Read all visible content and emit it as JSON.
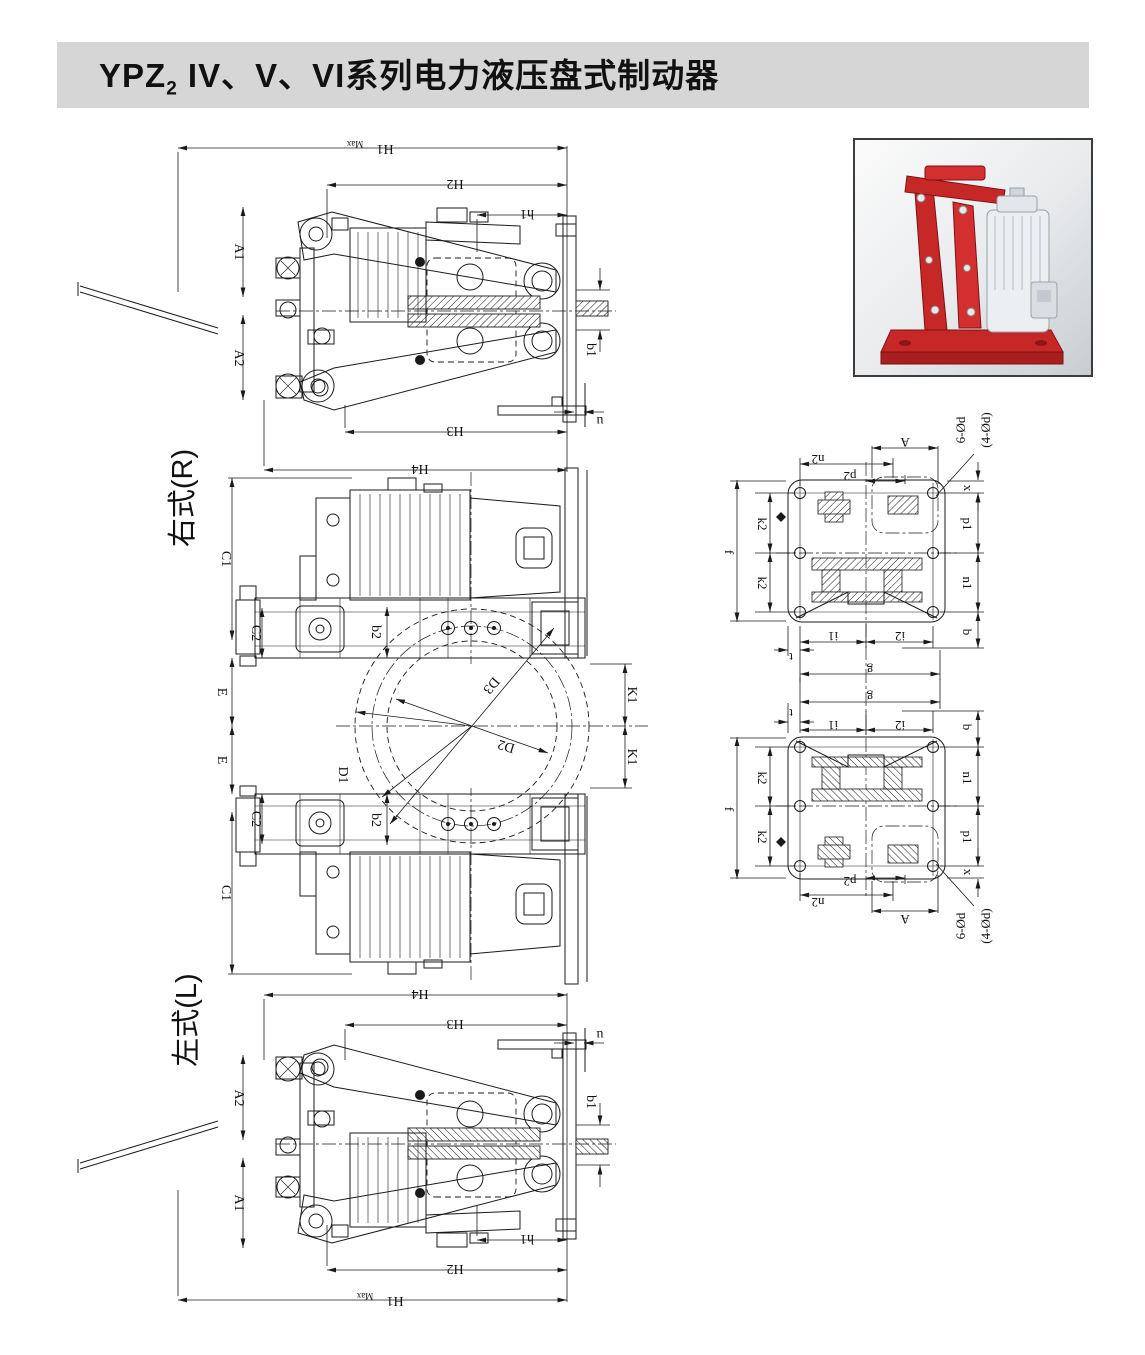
{
  "title": {
    "prefix": "YPZ",
    "sub": "2",
    "suffix": " IV、V、VI系列电力液压盘式制动器"
  },
  "view_labels": {
    "right": "右式(R)",
    "left": "左式(L)"
  },
  "dims": {
    "H1": "H1",
    "H1_sub": "Max",
    "H2": "H2",
    "h1": "h1",
    "H3": "H3",
    "H4": "H4",
    "A1": "A1",
    "A2": "A2",
    "b1": "b1",
    "u": "u",
    "C1": "C1",
    "C2": "C2",
    "E": "E",
    "b2": "b2",
    "D1": "D1",
    "D2": "D2",
    "D3": "D3",
    "K1": "K1",
    "A": "A",
    "n2": "n2",
    "p2": "p2",
    "x": "x",
    "k2": "k2",
    "f": "f",
    "p1": "p1",
    "n1": "n1",
    "b": "b",
    "t": "t",
    "i1": "i1",
    "i2": "i2",
    "g": "g",
    "hole_note_1": "6-Ød",
    "hole_note_2": "(4-Ød)"
  },
  "colors": {
    "title_bar": "#d6d6d6",
    "line": "#1a1a1a",
    "brake_red": "#c62828",
    "thruster_gray": "#eceff2"
  }
}
